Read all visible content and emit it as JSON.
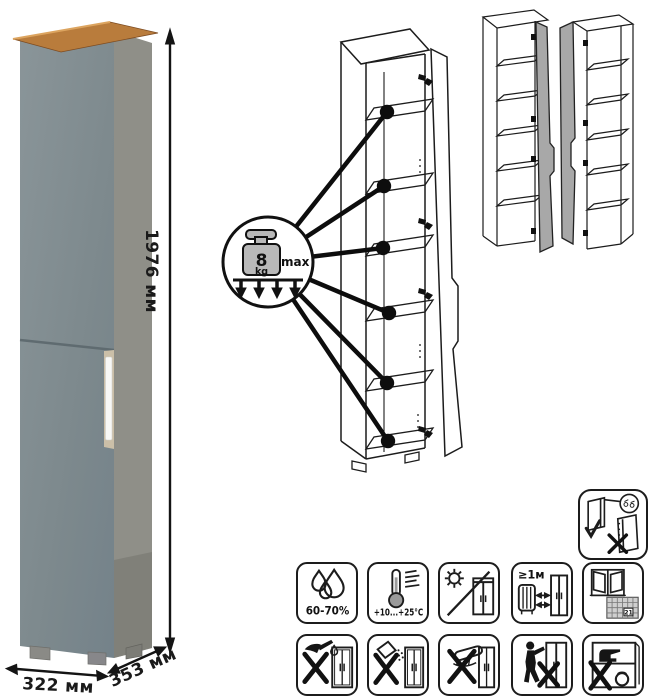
{
  "product_photo": {
    "dim_height": "1976 мм",
    "dim_width": "322 мм",
    "dim_depth": "353 мм",
    "colors": {
      "front": "#7d898d",
      "side": "#8f8f88",
      "top_wood": "#b97c3c",
      "handle": "#f8f8f6",
      "handle_recess": "#cbbfa8"
    }
  },
  "shelf_callout": {
    "weight_value": "8",
    "weight_unit": "kg",
    "max_label": "max",
    "shelves_marked": 6
  },
  "care_icons": {
    "humidity": {
      "label": "60-70%"
    },
    "temperature": {
      "label": "+10...+25°C"
    },
    "heat_distance": {
      "label": "≥1м"
    },
    "ventilation": {
      "calendar_day": "21"
    }
  },
  "icon_names": [
    "door-mounting-icon",
    "humidity-icon",
    "temperature-icon",
    "no-direct-sunlight-icon",
    "heat-distance-icon",
    "ventilation-calendar-icon",
    "no-sharp-tools-icon",
    "no-abrasive-powder-icon",
    "no-wet-rubbing-icon",
    "no-dragging-icon",
    "no-overloading-icon"
  ]
}
